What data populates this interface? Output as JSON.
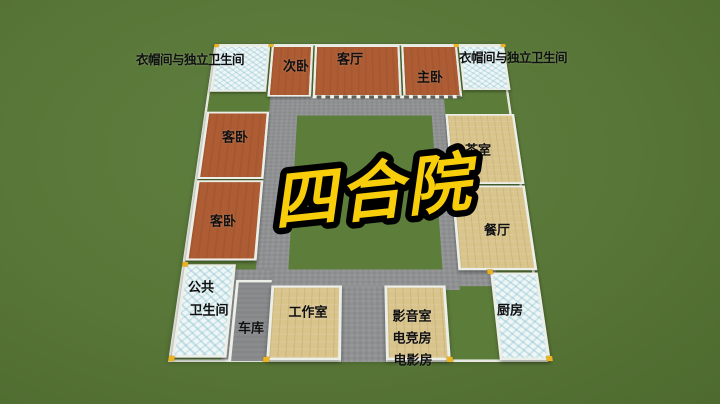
{
  "scene": {
    "title": "四合院"
  },
  "labels": {
    "wardrobe_left": "衣帽间与独立卫生间",
    "wardrobe_right": "衣帽间与独立卫生间",
    "secondary_bedroom": "次卧",
    "living_room": "客厅",
    "master_bedroom": "主卧",
    "guest_bedroom_upper": "客卧",
    "guest_bedroom_lower": "客卧",
    "tea_room": "茶室",
    "dining_room": "餐厅",
    "public_bath_line1": "公共",
    "public_bath_line2": "卫生间",
    "garage": "车库",
    "studio": "工作室",
    "media_room": "影音室",
    "esports_room": "电竞房",
    "movie_room": "电影房",
    "kitchen": "厨房"
  },
  "colors": {
    "grass": "#587637",
    "terracotta_floor": "#ad5c33",
    "plank_floor": "#d9c48c",
    "tile_floor": "#eef6f6",
    "path_gray": "#8f9192",
    "wall_white": "#eceee8",
    "corner_gold": "#e9b322",
    "title_yellow": "#f8cd0a",
    "label_black": "#101010"
  }
}
